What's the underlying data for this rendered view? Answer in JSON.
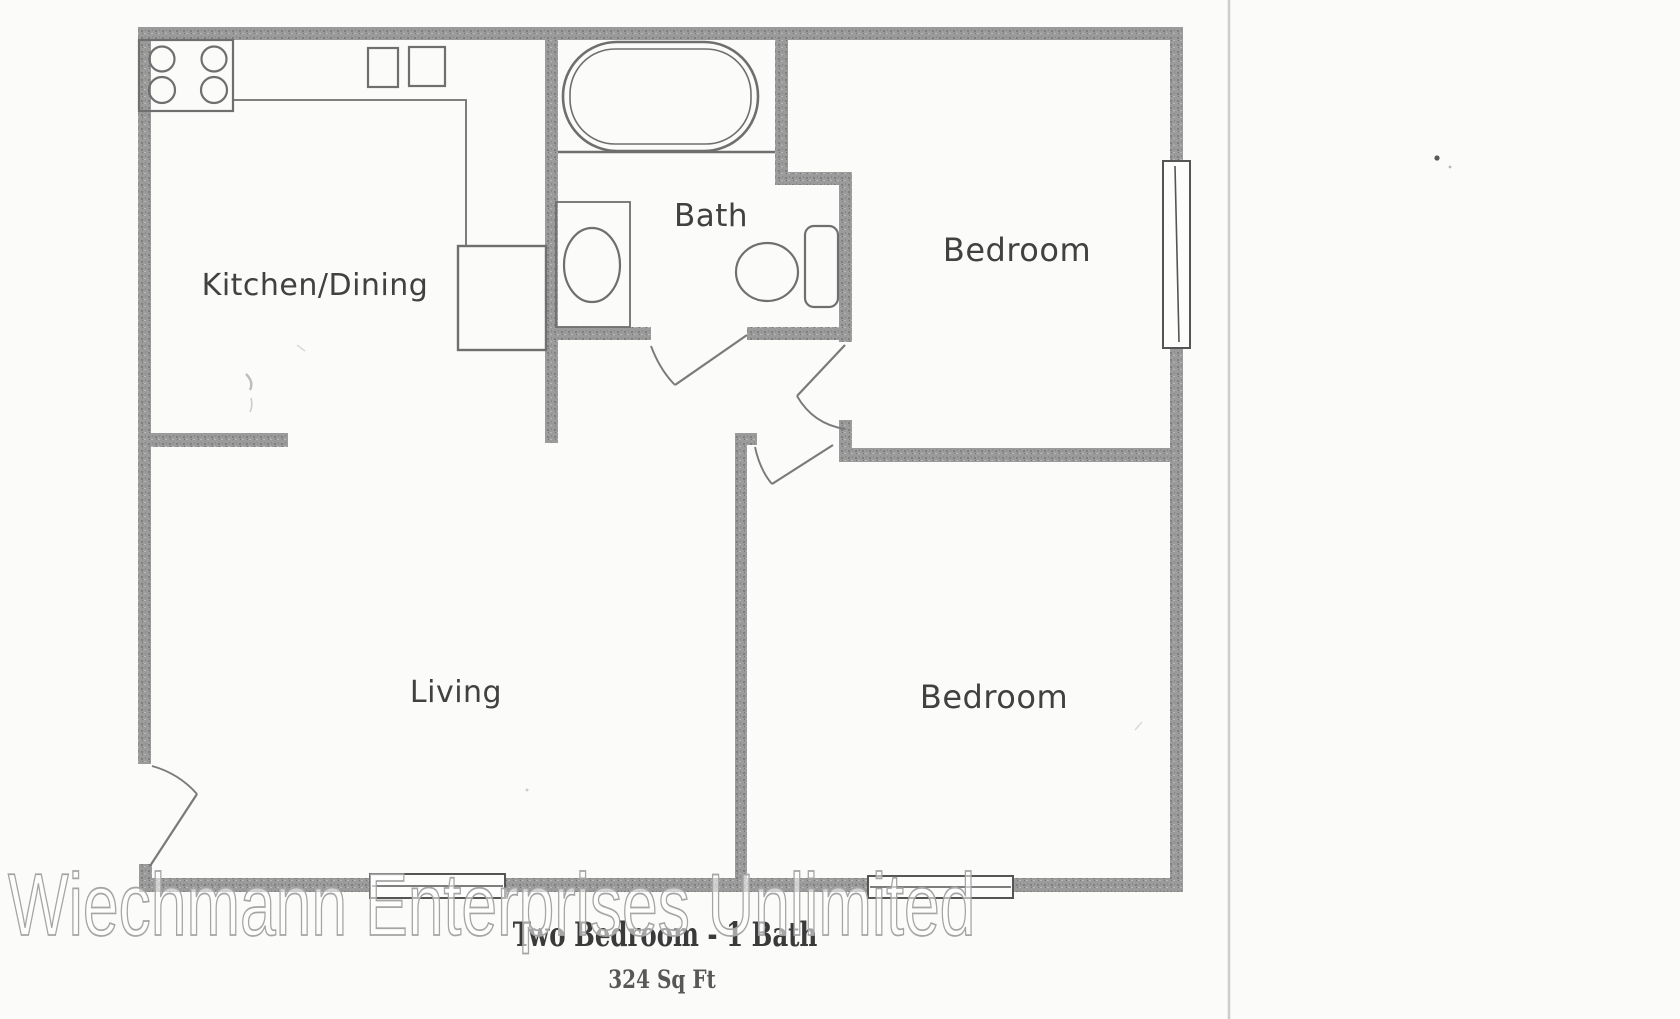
{
  "document": {
    "kind": "scanned floor plan",
    "title": "Two Bedroom - 1 Bath",
    "area_label": "324 Sq Ft",
    "watermark": "Wiechmann Enterprises Unlimited"
  },
  "rooms": {
    "kitchen_dining": {
      "label": "Kitchen/Dining"
    },
    "bath": {
      "label": "Bath"
    },
    "bedroom_upper": {
      "label": "Bedroom"
    },
    "living": {
      "label": "Living"
    },
    "bedroom_lower": {
      "label": "Bedroom"
    }
  },
  "fixtures": {
    "stove": "4-burner stove",
    "kitchen_sink": "double kitchen sink",
    "bathtub": "bathtub",
    "vanity_sink": "bathroom vanity sink",
    "toilet": "toilet",
    "closet": "utility closet",
    "window_count": 3,
    "door_count": 4
  },
  "colors": {
    "paper": "#fbfbf9",
    "wall": "#9b9b9b",
    "wall_speckle_dark": "#7f7f7f",
    "wall_speckle_light": "#b8b8b8",
    "fixture_line": "#6f6f6f",
    "door_line": "#7a7a7a",
    "label_ink": "#414141",
    "title_ink": "#3a3a3a",
    "watermark_stroke": "#a5a5a5",
    "watermark_fill": "rgba(255,255,255,0.55)",
    "scan_edge_line": "#c9c9c7"
  }
}
